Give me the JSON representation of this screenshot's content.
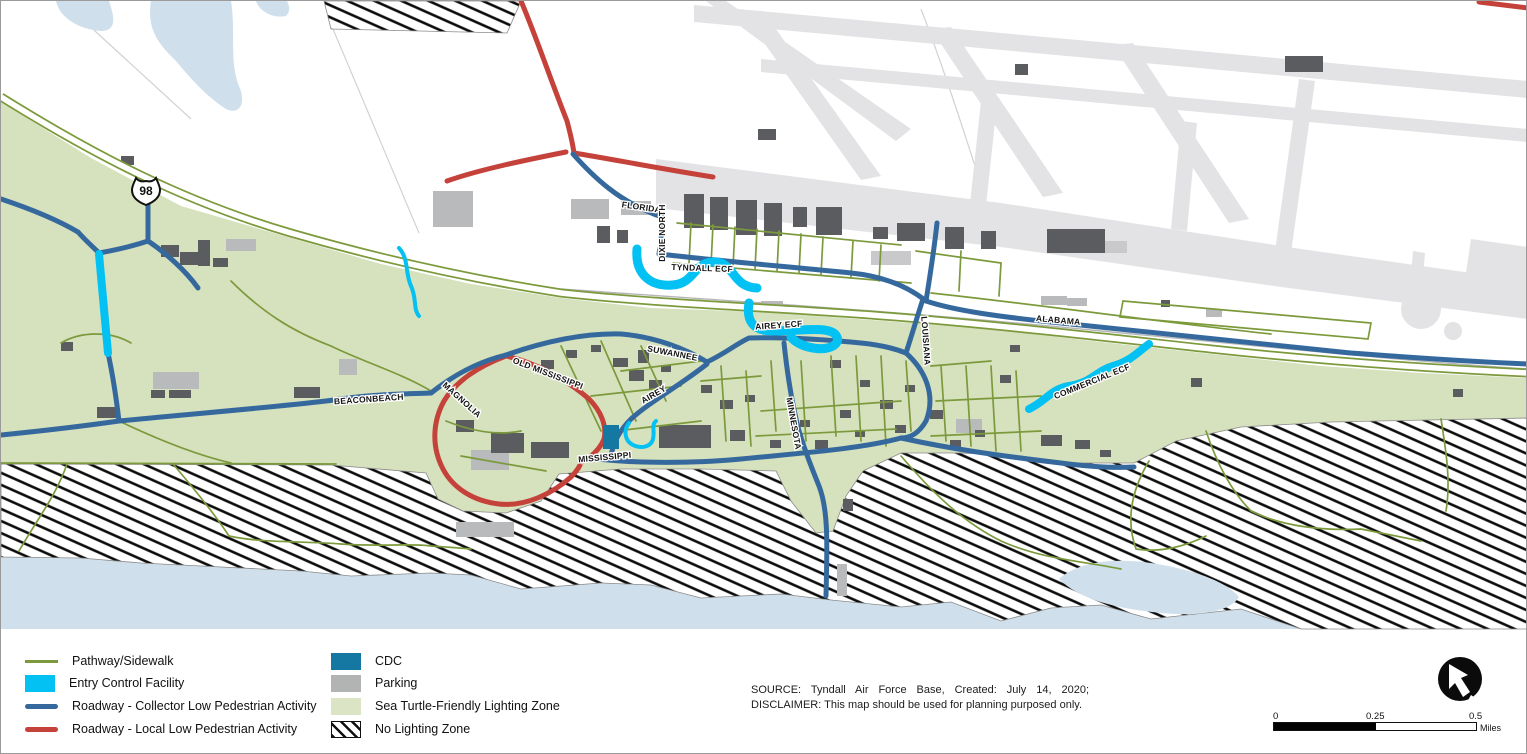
{
  "map": {
    "highway_shield": "98",
    "labels": [
      {
        "text": "FLORIDA",
        "kind": "road"
      },
      {
        "text": "DIXIE NORTH",
        "kind": "road"
      },
      {
        "text": "TYNDALL ECF",
        "kind": "ecf"
      },
      {
        "text": "AIREY ECF",
        "kind": "ecf"
      },
      {
        "text": "SUWANNEE",
        "kind": "road"
      },
      {
        "text": "AIREY",
        "kind": "road"
      },
      {
        "text": "LOUISIANA",
        "kind": "road"
      },
      {
        "text": "MINNESOTA",
        "kind": "road"
      },
      {
        "text": "ALABAMA",
        "kind": "road"
      },
      {
        "text": "COMMERCIAL ECF",
        "kind": "ecf"
      },
      {
        "text": "BEACONBEACH",
        "kind": "road"
      },
      {
        "text": "MAGNOLIA",
        "kind": "road"
      },
      {
        "text": "OLD MISSISSIPPI",
        "kind": "road"
      },
      {
        "text": "MISSISSIPPI",
        "kind": "road"
      }
    ]
  },
  "legend": {
    "items_left": [
      {
        "label": "Pathway/Sidewalk",
        "swatch": "line-olive"
      },
      {
        "label": "Entry Control Facility",
        "swatch": "box-cyan"
      },
      {
        "label": "Roadway - Collector Low Pedestrian Activity",
        "swatch": "line-blue"
      },
      {
        "label": "Roadway - Local Low Pedestrian Activity",
        "swatch": "line-red"
      }
    ],
    "items_right": [
      {
        "label": "CDC",
        "swatch": "box-teal"
      },
      {
        "label": "Parking",
        "swatch": "box-gray"
      },
      {
        "label": "Sea Turtle-Friendly Lighting Zone",
        "swatch": "box-green"
      },
      {
        "label": "No Lighting Zone",
        "swatch": "box-hatch"
      }
    ]
  },
  "source": {
    "line1": "SOURCE: Tyndall Air Force Base, Created: July 14, 2020;",
    "line2": "DISCLAIMER: This map should be used for planning purposed only."
  },
  "scalebar": {
    "start": "0",
    "mid": "0.25",
    "end": "0.5",
    "unit": "Miles"
  },
  "colors": {
    "zone_green": "#d6e1bd",
    "pathway_olive": "#7c9a3c",
    "collector_blue": "#35699e",
    "local_red": "#c5423b",
    "ecf_cyan": "#03c1f3",
    "cdc_teal": "#1478a3",
    "parking_gray": "#b2b4b3",
    "water_blue": "#cfe0ec",
    "airport_gray": "#e3e3e5",
    "building_gray": "#5a5c5f"
  }
}
